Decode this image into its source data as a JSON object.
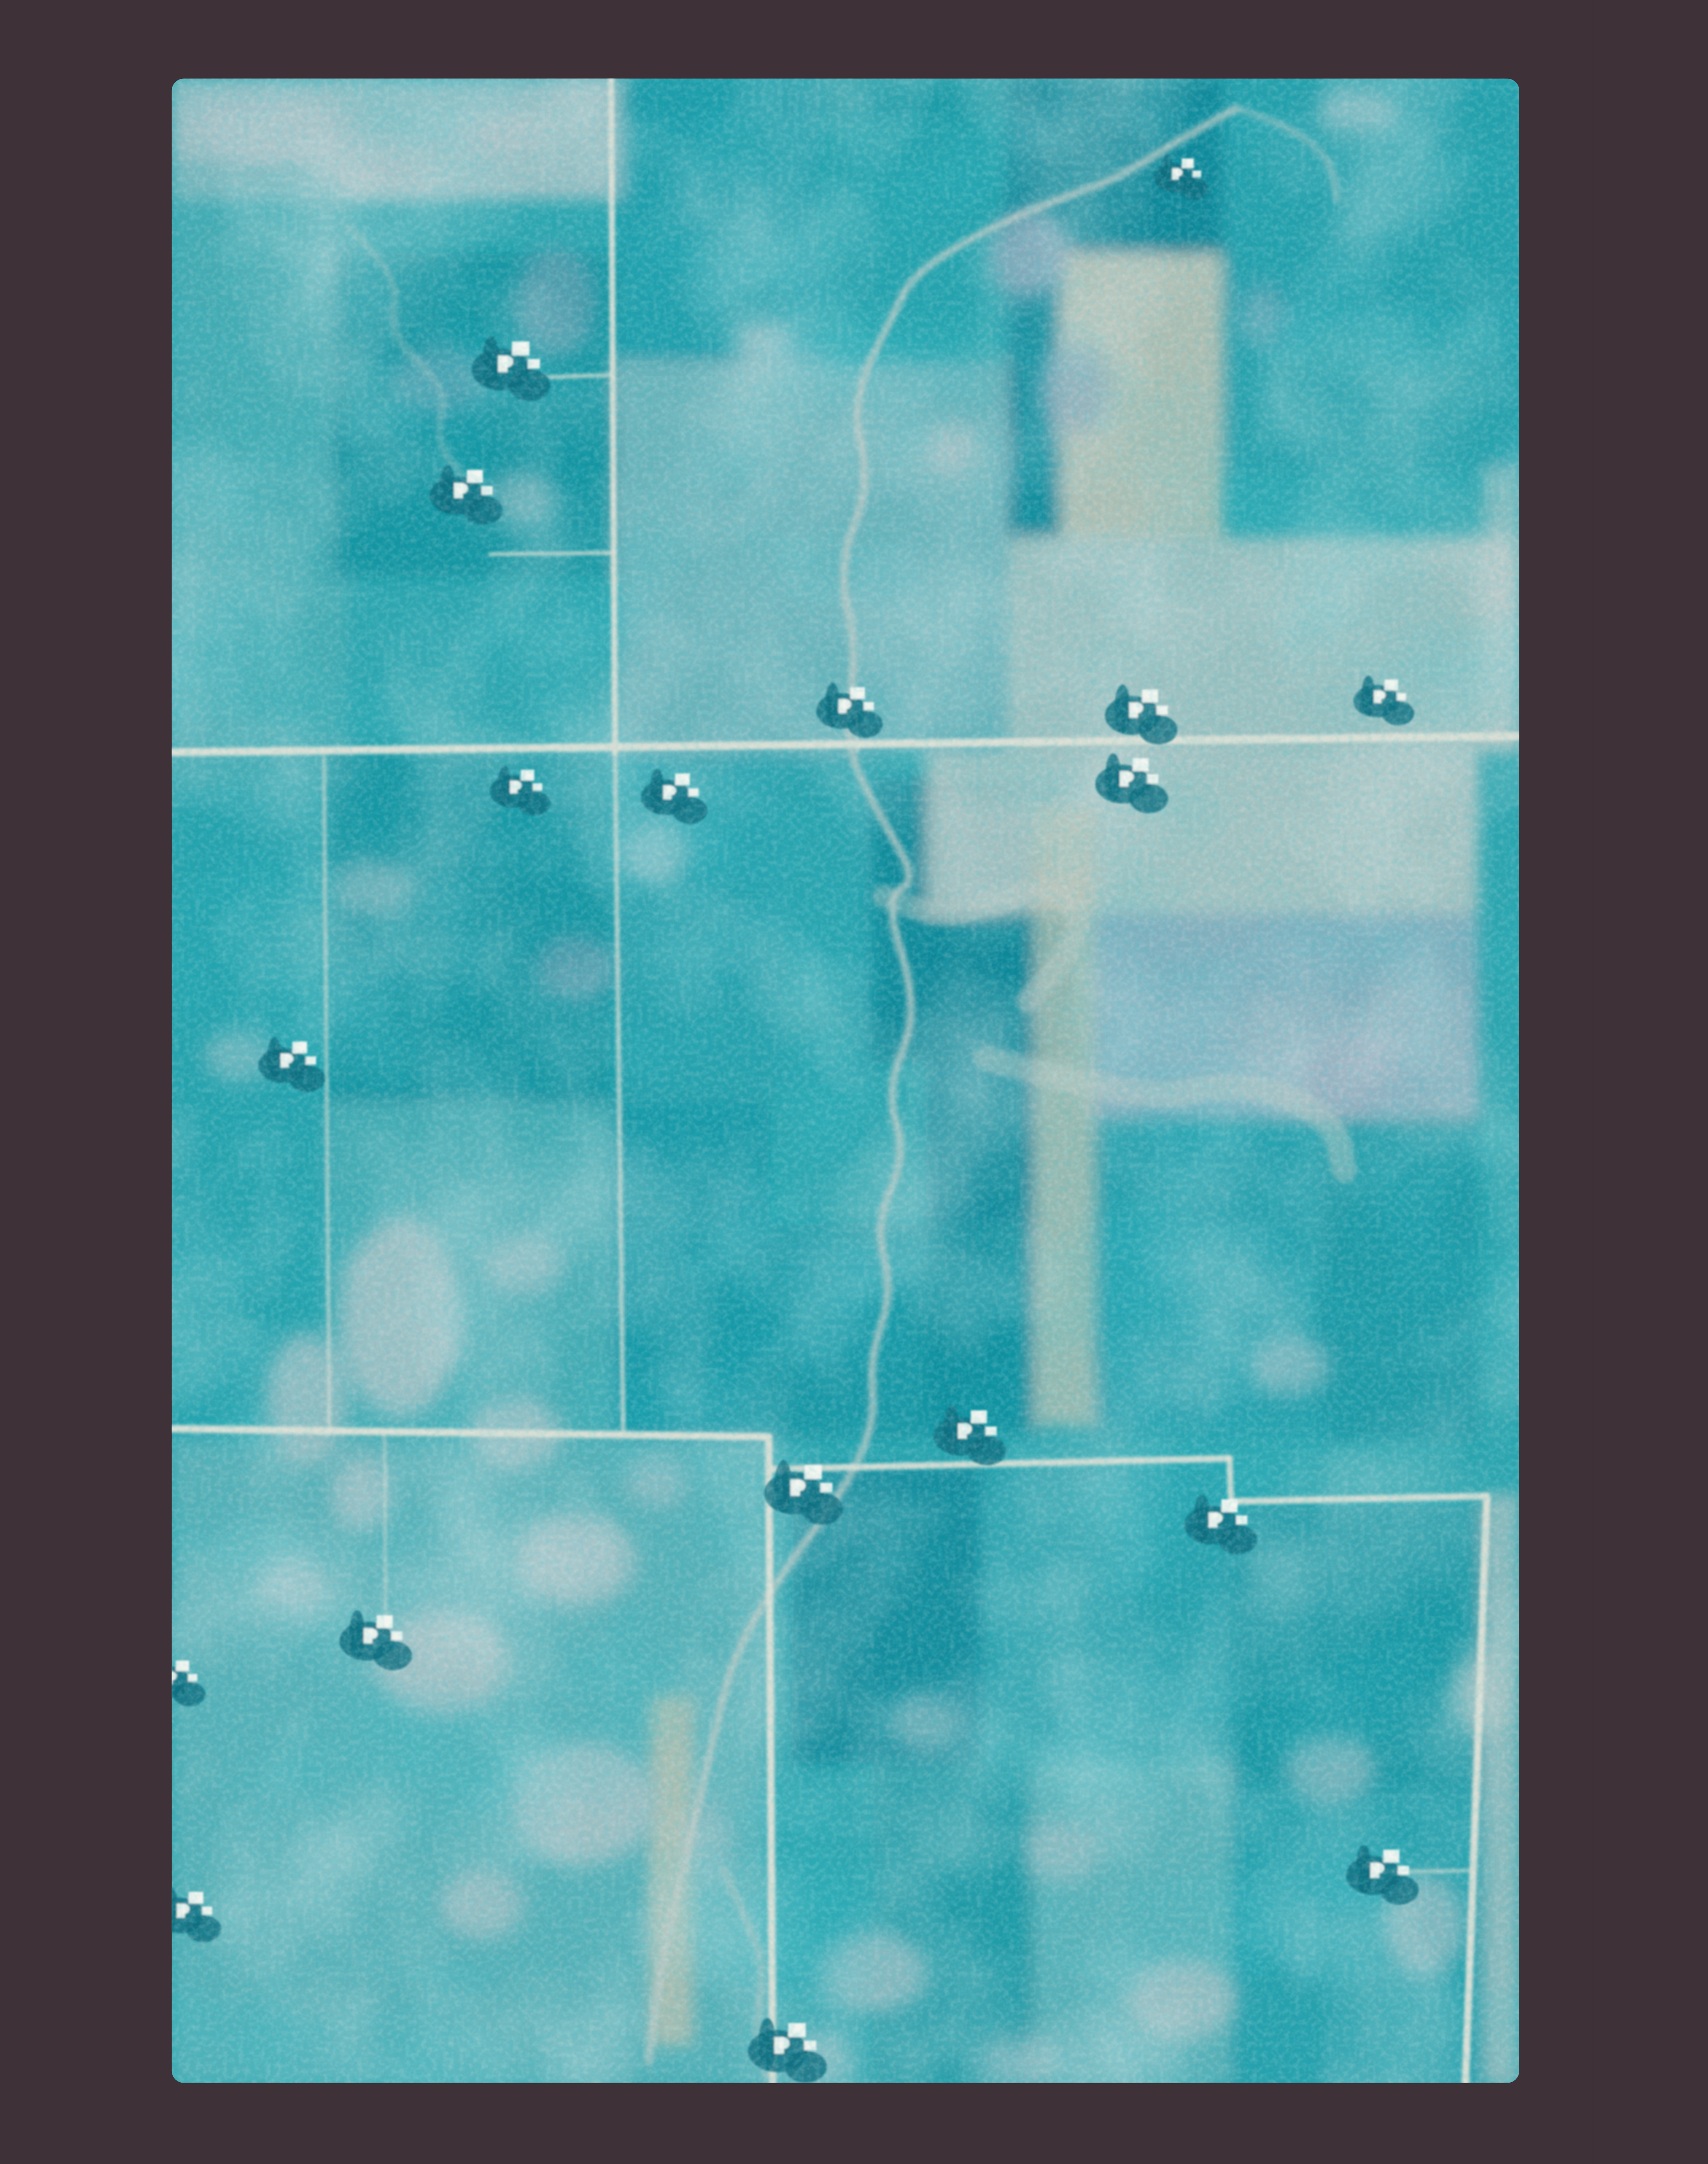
{
  "scene": {
    "title": "False-color aerial photograph of agricultural farmland",
    "description": "Cyan-toned vertical aerial photo mounted on a dark mauve film border. A patchwork of rectangular crop fields in teal tones, section-line gravel roads, scattered farmsteads with white buildings and dark windbreak groves, a meandering creek running north-south, gray sloughs and ponds in the lower-left, and pale soil washes on the right.",
    "photo_type": "aerial-photo",
    "visible_text": ""
  },
  "palette": {
    "border": "#3e3138",
    "photo_base": "#2da5af",
    "teal_mid": "#1f9dab",
    "teal_dark": "#12919f",
    "teal_deep": "#0d8798",
    "teal_light": "#5cb2b8",
    "teal_pale": "#7fbcc0",
    "gray_light": "#a9c2c6",
    "gray_pale": "#b6c5c3",
    "lavender": "#a3b2c2",
    "slate": "#8ea6b8",
    "beige": "#b9c0b2",
    "road": "#d9ded4",
    "creek": "#bccac5",
    "building": "#f3f6f0",
    "trees": "#0d6e7f",
    "grain_dark": "#0a7888"
  },
  "canvas": {
    "view_w": 109.6,
    "view_h": 160.6,
    "photo": {
      "x": 4.17,
      "y": 5.83,
      "w": 100,
      "h": 148.75,
      "rx": 0.9
    }
  },
  "fields": [
    [
      0,
      0,
      34,
      9,
      "gray_light",
      0.85
    ],
    [
      33,
      0,
      45,
      3,
      "teal_deep",
      0.4
    ],
    [
      0,
      6,
      13,
      46,
      "teal_light",
      0.5
    ],
    [
      12,
      13,
      21,
      24,
      "teal_dark",
      0.8
    ],
    [
      33,
      0,
      15,
      21,
      "teal_mid",
      0.7
    ],
    [
      48,
      0,
      14,
      19,
      "teal_mid",
      0.4
    ],
    [
      33,
      21,
      29,
      29,
      "gray_light",
      0.5
    ],
    [
      62,
      0,
      16,
      13,
      "teal_deep",
      0.95
    ],
    [
      62,
      13,
      4,
      21,
      "teal_deep",
      0.8
    ],
    [
      66,
      13,
      12,
      21,
      "beige",
      0.9
    ],
    [
      78,
      0,
      22,
      17,
      "teal_mid",
      0.75
    ],
    [
      78,
      17,
      22,
      12,
      "teal_mid",
      0.45
    ],
    [
      62,
      34,
      38,
      16,
      "gray_pale",
      0.8
    ],
    [
      97.4,
      29,
      2.6,
      21,
      "gray_pale",
      0.6
    ],
    [
      0,
      50,
      11.5,
      51,
      "teal_mid",
      0.4
    ],
    [
      11.5,
      50,
      21.3,
      26,
      "teal_dark",
      0.75
    ],
    [
      11.5,
      76,
      21.3,
      25,
      "teal_light",
      0.5
    ],
    [
      32.8,
      50,
      11.5,
      51,
      "teal_mid",
      0.5
    ],
    [
      44.3,
      50,
      7.7,
      25,
      "teal_mid",
      0.45
    ],
    [
      52,
      52,
      15,
      21,
      "teal_deep",
      0.9
    ],
    [
      56,
      50,
      41,
      12,
      "gray_pale",
      0.85
    ],
    [
      68,
      62,
      29,
      15,
      "lavender",
      0.75
    ],
    [
      56,
      64,
      8,
      36,
      "teal_deep",
      0.8
    ],
    [
      64,
      54,
      4.5,
      46,
      "beige",
      0.75
    ],
    [
      68.5,
      77,
      28.5,
      24,
      "teal_mid",
      0.55
    ],
    [
      85,
      77,
      12,
      24,
      "teal_dark",
      0.5
    ],
    [
      44.3,
      85,
      19.7,
      16,
      "teal_dark",
      0.7
    ],
    [
      33,
      76,
      11.3,
      25,
      "teal_dark",
      0.45
    ],
    [
      0,
      101,
      44.3,
      48,
      "teal_pale",
      0.5
    ],
    [
      0,
      101,
      20,
      19,
      "teal_light",
      0.4
    ],
    [
      46,
      103,
      14,
      22,
      "teal_deep",
      0.8
    ],
    [
      60,
      103,
      18.5,
      21,
      "teal_mid",
      0.5
    ],
    [
      52,
      125,
      12,
      24,
      "teal_dark",
      0.55
    ],
    [
      78.5,
      106,
      18.9,
      21,
      "teal_dark",
      0.65
    ],
    [
      78.5,
      127,
      18.9,
      22,
      "teal_mid",
      0.5
    ],
    [
      64,
      125,
      14.5,
      24,
      "teal_pale",
      0.55
    ],
    [
      35.5,
      120,
      3.2,
      26,
      "beige",
      0.8
    ],
    [
      97.4,
      105,
      2.6,
      44,
      "gray_pale",
      0.7
    ]
  ],
  "ponds": [
    [
      7,
      3.5,
      6,
      2.6,
      "gray_light",
      0.9
    ],
    [
      15,
      6.5,
      4.5,
      2,
      "gray_light",
      0.8
    ],
    [
      24,
      4,
      3.5,
      1.8,
      "gray_light",
      0.7
    ],
    [
      28.5,
      16.5,
      3,
      4,
      "slate",
      0.5
    ],
    [
      20,
      22.5,
      3.5,
      2.5,
      "slate",
      0.45
    ],
    [
      26,
      31,
      2.5,
      2,
      "gray_light",
      0.5
    ],
    [
      63.5,
      13,
      2.8,
      3.4,
      "slate",
      0.75
    ],
    [
      67,
      23,
      2.6,
      3.4,
      "slate",
      0.7
    ],
    [
      57.8,
      27.5,
      1.8,
      2.2,
      "gray_light",
      0.8
    ],
    [
      44,
      19.5,
      2.2,
      1.4,
      "gray_light",
      0.7
    ],
    [
      88,
      2.5,
      3,
      1.6,
      "gray_light",
      0.6
    ],
    [
      81,
      17.5,
      1.8,
      2.4,
      "slate",
      0.4
    ],
    [
      36,
      57.5,
      2.6,
      2,
      "gray_light",
      0.6
    ],
    [
      30,
      66,
      3,
      2.4,
      "slate",
      0.5
    ],
    [
      15,
      60,
      3,
      2.2,
      "gray_light",
      0.5
    ],
    [
      5,
      72.5,
      2.6,
      2,
      "gray_light",
      0.55
    ],
    [
      26,
      88,
      3,
      2.4,
      "gray_light",
      0.6
    ],
    [
      87.7,
      74,
      4,
      3,
      "slate",
      0.75
    ],
    [
      83,
      95.5,
      3,
      2.2,
      "gray_light",
      0.6
    ],
    [
      17,
      92,
      4.5,
      7.5,
      "gray_light",
      0.85
    ],
    [
      10,
      98,
      3,
      5,
      "gray_light",
      0.8
    ],
    [
      25.5,
      100.5,
      3.5,
      2.6,
      "gray_light",
      0.8
    ],
    [
      14,
      105,
      2.2,
      3,
      "gray_light",
      0.7
    ],
    [
      30,
      110,
      4.5,
      3.4,
      "gray_light",
      0.8
    ],
    [
      20,
      117.5,
      5,
      4,
      "gray_light",
      0.85
    ],
    [
      30.5,
      128,
      5.5,
      4.5,
      "gray_light",
      0.85
    ],
    [
      23,
      135.5,
      3.2,
      2.6,
      "gray_light",
      0.7
    ],
    [
      9,
      112,
      2.6,
      2,
      "gray_light",
      0.6
    ],
    [
      40,
      131,
      2,
      3.4,
      "gray_light",
      0.5
    ],
    [
      52,
      140.5,
      4,
      3,
      "gray_light",
      0.7
    ],
    [
      47.5,
      147,
      3,
      2,
      "gray_light",
      0.6
    ],
    [
      66,
      131.5,
      3,
      2.4,
      "gray_light",
      0.6
    ],
    [
      56,
      122,
      2.6,
      2,
      "gray_light",
      0.5
    ],
    [
      75,
      142.5,
      4,
      3,
      "gray_light",
      0.75
    ],
    [
      86,
      125.5,
      3.4,
      2.6,
      "gray_light",
      0.6
    ],
    [
      93,
      137,
      3,
      3.8,
      "gray_light",
      0.7
    ],
    [
      97,
      120,
      2,
      3,
      "gray_pale",
      0.6
    ],
    [
      63,
      147,
      3,
      2,
      "gray_light",
      0.5
    ],
    [
      36,
      104,
      2.4,
      2,
      "gray_light",
      0.6
    ]
  ],
  "streams": [
    {
      "points": [
        [
          79,
          2.2
        ],
        [
          75.5,
          4.1
        ],
        [
          70,
          7.5
        ],
        [
          66.4,
          8.7
        ],
        [
          60.4,
          11.2
        ],
        [
          55,
          14.5
        ],
        [
          53.4,
          17.8
        ],
        [
          50.4,
          23.9
        ],
        [
          51.9,
          30.1
        ],
        [
          49.4,
          36.2
        ],
        [
          50.9,
          42.3
        ],
        [
          49.9,
          49.4
        ],
        [
          52.4,
          54.5
        ],
        [
          55.4,
          59.6
        ],
        [
          52.8,
          60.7
        ],
        [
          55.5,
          69.2
        ],
        [
          53,
          75
        ],
        [
          54.5,
          80
        ],
        [
          52.2,
          85
        ],
        [
          53.5,
          90
        ],
        [
          51.8,
          95
        ],
        [
          52.2,
          99.7
        ],
        [
          50,
          104.6
        ],
        [
          44.5,
          112
        ],
        [
          41.4,
          117.7
        ],
        [
          39.4,
          126.8
        ],
        [
          36.4,
          139.1
        ],
        [
          35.4,
          147.2
        ]
      ],
      "width": 0.5,
      "opacity": 0.9
    },
    {
      "points": [
        [
          52.8,
          60.7
        ],
        [
          56.5,
          62.3
        ],
        [
          60.5,
          61.6
        ],
        [
          64,
          60
        ],
        [
          66.5,
          60.6
        ],
        [
          67.5,
          63
        ],
        [
          65.5,
          66.2
        ],
        [
          63.5,
          68.5
        ]
      ],
      "width": 1.7,
      "opacity": 0.45
    },
    {
      "points": [
        [
          60.4,
          72.7
        ],
        [
          66.5,
          74.3
        ],
        [
          73.3,
          75.7
        ],
        [
          78,
          74.6
        ],
        [
          83,
          75.4
        ],
        [
          86.5,
          78
        ],
        [
          87,
          81
        ]
      ],
      "width": 1.9,
      "opacity": 0.45
    },
    {
      "points": [
        [
          79,
          2.2
        ],
        [
          83,
          3.5
        ],
        [
          86,
          6
        ],
        [
          86.5,
          9
        ]
      ],
      "width": 0.5,
      "opacity": 0.5
    },
    {
      "points": [
        [
          41,
          133
        ],
        [
          42.6,
          136.5
        ],
        [
          44,
          140
        ],
        [
          43.4,
          144
        ],
        [
          44.2,
          148.5
        ]
      ],
      "width": 0.6,
      "opacity": 0.5
    },
    {
      "points": [
        [
          13,
          11
        ],
        [
          17,
          14.5
        ],
        [
          16,
          19
        ],
        [
          20.5,
          23
        ],
        [
          19.5,
          27
        ],
        [
          22,
          30
        ]
      ],
      "width": 0.5,
      "opacity": 0.35
    }
  ],
  "roads": [
    [
      0,
      50.0,
      100,
      48.8,
      0.6,
      1
    ],
    [
      32.6,
      0,
      32.9,
      50,
      0.45,
      0.95
    ],
    [
      32.9,
      50,
      33.5,
      100.4,
      0.35,
      0.7
    ],
    [
      11.3,
      50.4,
      11.7,
      100.6,
      0.3,
      0.6
    ],
    [
      0,
      100.2,
      44.3,
      100.8,
      0.55,
      1
    ],
    [
      44.3,
      100.8,
      44.6,
      148.75,
      0.55,
      1
    ],
    [
      44.3,
      103.2,
      78.5,
      102.4,
      0.5,
      0.95
    ],
    [
      78.5,
      102.4,
      78.6,
      105.6,
      0.45,
      0.9
    ],
    [
      78.6,
      105.6,
      97.6,
      105.2,
      0.5,
      0.95
    ],
    [
      97.6,
      105.2,
      96.0,
      148.75,
      0.55,
      1
    ],
    [
      32.7,
      22.0,
      27.0,
      22.2,
      0.28,
      0.8
    ],
    [
      32.8,
      35.2,
      23.6,
      35.3,
      0.28,
      0.8
    ],
    [
      50.9,
      49.9,
      50.7,
      47.2,
      0.25,
      0.8
    ],
    [
      96.2,
      133.0,
      90.5,
      133.1,
      0.3,
      0.6
    ],
    [
      15.8,
      100.8,
      15.9,
      118,
      0.25,
      0.5
    ]
  ],
  "farmsteads": [
    {
      "x": 25.9,
      "y": 21.2,
      "s": 1.3
    },
    {
      "x": 22.5,
      "y": 30.6,
      "s": 1.2
    },
    {
      "x": 50.9,
      "y": 46.6,
      "s": 1.1
    },
    {
      "x": 72.6,
      "y": 46.9,
      "s": 1.2
    },
    {
      "x": 90.5,
      "y": 45.9,
      "s": 1.0
    },
    {
      "x": 26.4,
      "y": 52.6,
      "s": 1.0
    },
    {
      "x": 37.9,
      "y": 53.0,
      "s": 1.1
    },
    {
      "x": 71.9,
      "y": 52.0,
      "s": 1.2
    },
    {
      "x": 9.5,
      "y": 72.9,
      "s": 1.1
    },
    {
      "x": 59.9,
      "y": 100.4,
      "s": 1.2
    },
    {
      "x": 47.6,
      "y": 104.6,
      "s": 1.3
    },
    {
      "x": 78.5,
      "y": 107.0,
      "s": 1.2
    },
    {
      "x": 15.8,
      "y": 115.6,
      "s": 1.2
    },
    {
      "x": 0.8,
      "y": 118.7,
      "s": 1.0
    },
    {
      "x": 1.8,
      "y": 136.0,
      "s": 1.1
    },
    {
      "x": 90.5,
      "y": 133.0,
      "s": 1.2
    },
    {
      "x": 46.4,
      "y": 146.0,
      "s": 1.3
    },
    {
      "x": 75.4,
      "y": 7.1,
      "s": 0.9
    }
  ]
}
